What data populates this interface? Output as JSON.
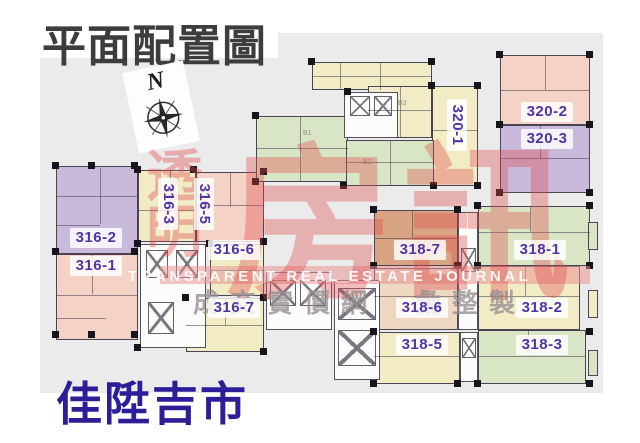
{
  "title": "平面配置圖",
  "project_name": "佳陞吉市",
  "compass": {
    "label": "N"
  },
  "watermark": {
    "cjk_vertical": "透明",
    "cjk_large": "房訊",
    "english": "TRANSPARENT REAL ESTATE JOURNAL",
    "tagline": "成交實價網　彙整製"
  },
  "core_labels": [
    {
      "label": "B1"
    },
    {
      "label": "B2"
    },
    {
      "label": "B3"
    }
  ],
  "units": [
    {
      "label": "316-2",
      "fill": "purple"
    },
    {
      "label": "316-1",
      "fill": "pink"
    },
    {
      "label": "316-3",
      "fill": "cream"
    },
    {
      "label": "316-5",
      "fill": "pink"
    },
    {
      "label": "316-6",
      "fill": "cream"
    },
    {
      "label": "316-7",
      "fill": "cream"
    },
    {
      "label": "320-1",
      "fill": "cream"
    },
    {
      "label": "320-2",
      "fill": "pink"
    },
    {
      "label": "320-3",
      "fill": "purple"
    },
    {
      "label": "318-7",
      "fill": "tan"
    },
    {
      "label": "318-1",
      "fill": "green"
    },
    {
      "label": "318-6",
      "fill": "pinkcream"
    },
    {
      "label": "318-2",
      "fill": "cream"
    },
    {
      "label": "318-5",
      "fill": "cream"
    },
    {
      "label": "318-3",
      "fill": "green"
    }
  ],
  "colors": {
    "purple": "#c9badb",
    "pink": "#f4d2c6",
    "tan": "#d9a483",
    "cream": "#f2ecc5",
    "green": "#d9e6c6",
    "pinkcream": "#eed8c2",
    "label_text": "#5134a4",
    "watermark_red": "#dd4848",
    "title_text": "#3d3d3d",
    "project_text": "#2b1e96",
    "canvas_bg": "#ecebeb"
  }
}
